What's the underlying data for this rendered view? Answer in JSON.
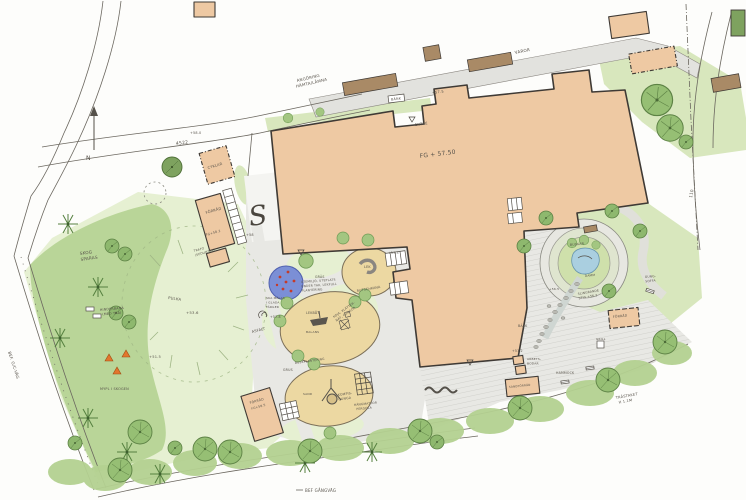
{
  "colors": {
    "paper": "#fdfdfb",
    "building": "#eec9a3",
    "brown_roof": "#a98a66",
    "ink": "#3f3a35",
    "lawn": "#d8e7bd",
    "lawn_light": "#e6f0d2",
    "forest": "#b4d191",
    "canopy": "#96bf74",
    "canopy_dark": "#7ea25f",
    "sand": "#ecd8a2",
    "asphalt": "#e8e8e4",
    "road_gray": "#e2e2de",
    "water": "#aacfe0",
    "splash_blue": "#7b8fd6",
    "splash_dot": "#c43b2a",
    "accent_orange": "#e2762d",
    "text": "#57524a"
  },
  "labels": {
    "road_4522": "4522",
    "angoring_line1": "ANGÖRING",
    "angoring_line2": "HÄMTA/LÄMNA",
    "varor": "VAROR",
    "north": "N",
    "num_110": "110",
    "bef_gc_vag": "BEF. G/C-VÄG",
    "bef_gangvag": "BEF GÅNGVÄG",
    "trastaket_line1": "TRÄSTAKET",
    "trastaket_line2": "H 1.1M",
    "fg_main": "FG + 57.50",
    "entre": "ENTRÉ",
    "bank": "BÄNK",
    "plus_575": "+57.5",
    "cyklar": "CYKLAR",
    "forrad_left": "FÖRRÅD",
    "fg_582": "FG+58.2",
    "trafo_line1": "TRAFO",
    "trafo_line2": "(SEDUMTAK)",
    "plus_580": "+58.0",
    "s_mark": "S",
    "plus_58": "+58",
    "skog_line1": "SKOG",
    "skog_line2": "SPARAS",
    "hinderbana_line1": "HINDERBANA",
    "hinderbana_line2": "(MED TRÄ)",
    "mypl": "MYPL I SKOGEN",
    "pulka": "PULKA",
    "plus_536": "+53.6",
    "plus_515": "+51.5",
    "gras": "GRÄS",
    "asfalt": "ASFALT",
    "plus_578": "+57.8",
    "malas_line1": "SKA MÅLAS",
    "malas_line2": "I GLADA",
    "malas_line3": "FÄRGER",
    "note_line1": "UTEMILJÖ, UTEPLATS",
    "note_line2": "UNDER TAK, LEKFULL",
    "note_line3": "PLANTERING",
    "lek": "LEK",
    "plus_573": "+57.3",
    "rutschkana": "RUTSCHKANA",
    "lekbat": "LEKBÅT",
    "balans": "BALANS",
    "koja_line1": "KOJA, KLÄTTER-",
    "koja_line2": "NÄT, GUNGOR",
    "buskplantering": "BUSKPLANTERING",
    "grus": "GRUS",
    "sand": "SAND",
    "kompis_line1": "KOMPIS-",
    "kompis_line2": "GUNGA",
    "pergola_line1": "HÄNGMATTOR",
    "pergola_line2": "PERGOLA",
    "forrad_center": "FÖRRÅD",
    "fg_585": "FG+58.5",
    "plus_572": "+57.2",
    "arbetsbodar_line1": "ARBETS-",
    "arbetsbodar_line2": "BODAR",
    "sandforrad": "SANDFÖRRÅD",
    "hammock": "HAMMOCK",
    "buskar": "BUSKAR",
    "damm": "DAMM",
    "back": "BÄCK",
    "plus_565": "+56.5",
    "slingrande_line1": "SLINGRANDE",
    "slingrande_line2": "STIG +56.2",
    "forrad_right": "FÖRRÅD",
    "grill": "GRILL",
    "gungsoffa_line1": "GUNG-",
    "gungsoffa_line2": "SOFFA"
  }
}
